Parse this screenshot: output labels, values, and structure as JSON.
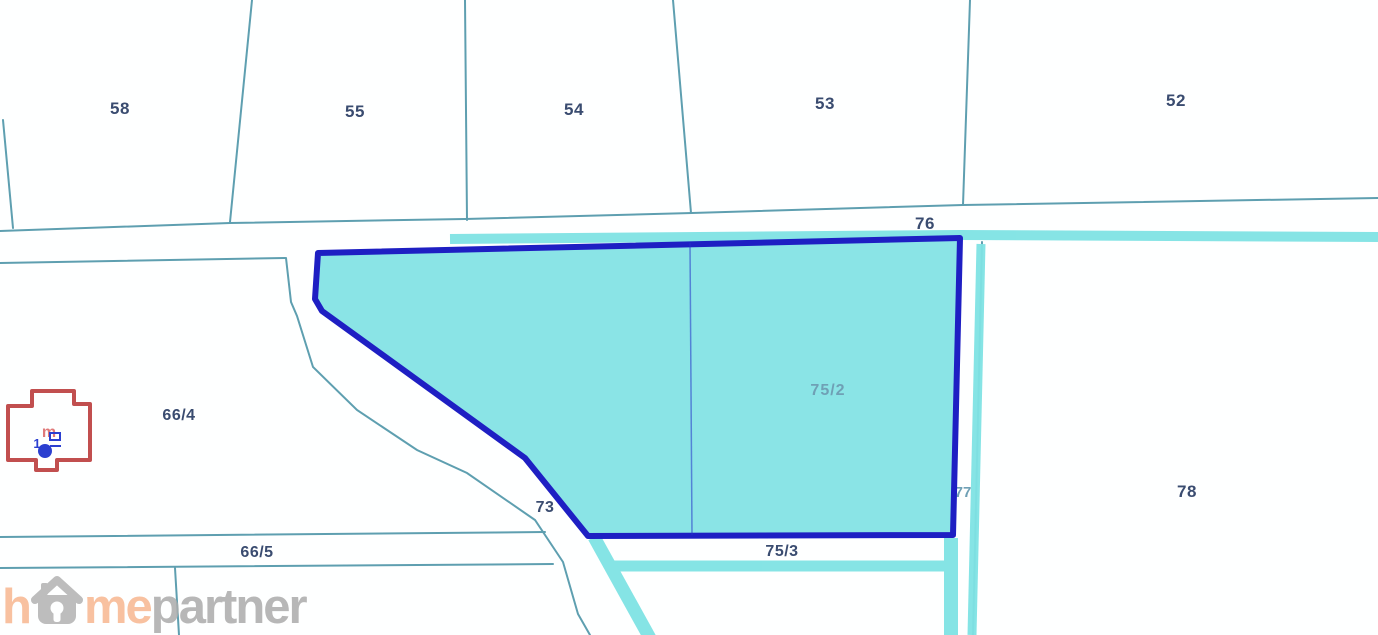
{
  "map": {
    "labels": {
      "p58": "58",
      "p55": "55",
      "p54": "54",
      "p53": "53",
      "p52": "52",
      "road76": "76",
      "p66_4": "66/4",
      "p73": "73",
      "p66_5": "66/5",
      "p75_2": "75/2",
      "p75_3": "75/3",
      "p77": "77",
      "p78": "78"
    },
    "building_symbol": {
      "letter_m": "m",
      "digit": "1"
    },
    "colors": {
      "highlight_fill": "#8AE4E6",
      "highlight_border": "#1E1FC3",
      "boundary_teal": "#5E9FB0",
      "road_highlight": "#7FE3E4",
      "label_navy": "#3A4C70",
      "muted_label": "#6FA0B5",
      "building_red": "#C14F4F",
      "watermark_salmon": "#F7B790",
      "watermark_gray": "#ABABAB"
    }
  },
  "watermark": {
    "part_h": "h",
    "part_me": "me",
    "part_partner": "partner",
    "house_icon": "house-icon"
  }
}
